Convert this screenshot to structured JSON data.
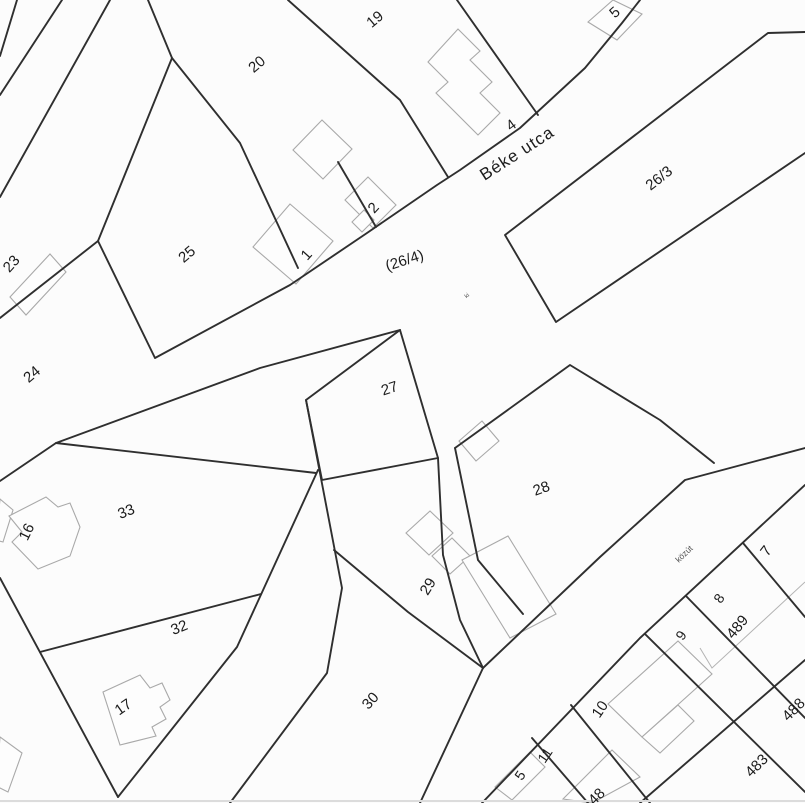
{
  "map": {
    "type": "cadastral-parcel-map",
    "street_name": "Béke utca",
    "road_label_center": "(26/4)",
    "road_label_right": "közút",
    "colors": {
      "background": "#fcfcfc",
      "parcel_boundary": "#2f2f2f",
      "building_outline": "#a9a9a9",
      "label_text": "#1c1c1c",
      "small_label_text": "#555555"
    },
    "labels": [
      {
        "id": "street-label-beke-utca",
        "text": "Béke utca",
        "x": 520,
        "y": 158,
        "rot": -33,
        "size": 17,
        "cls": "map-label",
        "ls": 1
      },
      {
        "id": "road-label-26-4",
        "text": "(26/4)",
        "x": 406,
        "y": 265,
        "rot": -18,
        "size": 15,
        "cls": "map-label",
        "ls": 0
      },
      {
        "id": "parcel-label-26-3",
        "text": "26/3",
        "x": 662,
        "y": 182,
        "rot": -38,
        "size": 15,
        "cls": "map-label",
        "ls": 0
      },
      {
        "id": "small-label-ki",
        "text": "ki",
        "x": 468,
        "y": 297,
        "rot": -40,
        "size": 6,
        "cls": "small-label",
        "ls": 0
      },
      {
        "id": "road-label-kozut",
        "text": "közút",
        "x": 686,
        "y": 556,
        "rot": -44,
        "size": 8.5,
        "cls": "small-label",
        "ls": 0
      },
      {
        "id": "parcel-label-19",
        "text": "19",
        "x": 378,
        "y": 23,
        "rot": -40,
        "size": 15,
        "cls": "map-label",
        "ls": 0
      },
      {
        "id": "parcel-label-20",
        "text": "20",
        "x": 260,
        "y": 68,
        "rot": -40,
        "size": 15,
        "cls": "map-label",
        "ls": 0
      },
      {
        "id": "parcel-label-5-top",
        "text": "5",
        "x": 618,
        "y": 16,
        "rot": -42,
        "size": 15,
        "cls": "map-label",
        "ls": 0
      },
      {
        "id": "parcel-label-4",
        "text": "4",
        "x": 514,
        "y": 129,
        "rot": -36,
        "size": 15,
        "cls": "map-label",
        "ls": 0
      },
      {
        "id": "parcel-label-23",
        "text": "23",
        "x": 15,
        "y": 267,
        "rot": -48,
        "size": 15,
        "cls": "map-label",
        "ls": 0
      },
      {
        "id": "parcel-label-25",
        "text": "25",
        "x": 190,
        "y": 258,
        "rot": -40,
        "size": 15,
        "cls": "map-label",
        "ls": 0
      },
      {
        "id": "parcel-label-1",
        "text": "1",
        "x": 310,
        "y": 258,
        "rot": -48,
        "size": 15,
        "cls": "map-label",
        "ls": 0
      },
      {
        "id": "parcel-label-2",
        "text": "2",
        "x": 377,
        "y": 211,
        "rot": -48,
        "size": 15,
        "cls": "map-label",
        "ls": 0
      },
      {
        "id": "parcel-label-24",
        "text": "24",
        "x": 35,
        "y": 378,
        "rot": -40,
        "size": 15,
        "cls": "map-label",
        "ls": 0
      },
      {
        "id": "parcel-label-27",
        "text": "27",
        "x": 391,
        "y": 393,
        "rot": -18,
        "size": 15,
        "cls": "map-label",
        "ls": 0
      },
      {
        "id": "parcel-label-28",
        "text": "28",
        "x": 543,
        "y": 493,
        "rot": -20,
        "size": 15,
        "cls": "map-label",
        "ls": 0
      },
      {
        "id": "parcel-label-33",
        "text": "33",
        "x": 128,
        "y": 516,
        "rot": -22,
        "size": 15,
        "cls": "map-label",
        "ls": 0
      },
      {
        "id": "parcel-label-16",
        "text": "16",
        "x": 31,
        "y": 534,
        "rot": -64,
        "size": 15,
        "cls": "map-label",
        "ls": 0
      },
      {
        "id": "parcel-label-29",
        "text": "29",
        "x": 432,
        "y": 589,
        "rot": -58,
        "size": 15,
        "cls": "map-label",
        "ls": 0
      },
      {
        "id": "parcel-label-32",
        "text": "32",
        "x": 181,
        "y": 632,
        "rot": -22,
        "size": 15,
        "cls": "map-label",
        "ls": 0
      },
      {
        "id": "parcel-label-17",
        "text": "17",
        "x": 126,
        "y": 711,
        "rot": -35,
        "size": 15,
        "cls": "map-label",
        "ls": 0
      },
      {
        "id": "parcel-label-30",
        "text": "30",
        "x": 374,
        "y": 704,
        "rot": -48,
        "size": 15,
        "cls": "map-label",
        "ls": 0
      },
      {
        "id": "parcel-label-7",
        "text": "7",
        "x": 770,
        "y": 554,
        "rot": -52,
        "size": 15,
        "cls": "map-label",
        "ls": 0
      },
      {
        "id": "parcel-label-8",
        "text": "8",
        "x": 723,
        "y": 601,
        "rot": -56,
        "size": 14,
        "cls": "map-label",
        "ls": 0
      },
      {
        "id": "parcel-label-489",
        "text": "489",
        "x": 741,
        "y": 630,
        "rot": -50,
        "size": 15,
        "cls": "map-label",
        "ls": 0
      },
      {
        "id": "parcel-label-9",
        "text": "9",
        "x": 685,
        "y": 638,
        "rot": -56,
        "size": 14,
        "cls": "map-label",
        "ls": 0
      },
      {
        "id": "parcel-label-10",
        "text": "10",
        "x": 604,
        "y": 712,
        "rot": -56,
        "size": 15,
        "cls": "map-label",
        "ls": 0
      },
      {
        "id": "parcel-label-488",
        "text": "488",
        "x": 797,
        "y": 713,
        "rot": -45,
        "size": 15,
        "cls": "map-label",
        "ls": 0
      },
      {
        "id": "parcel-label-483",
        "text": "483",
        "x": 760,
        "y": 769,
        "rot": -45,
        "size": 15,
        "cls": "map-label",
        "ls": 0
      },
      {
        "id": "parcel-label-11",
        "text": "11",
        "x": 549,
        "y": 758,
        "rot": -56,
        "size": 14,
        "cls": "map-label",
        "ls": 0
      },
      {
        "id": "parcel-label-5-bottom",
        "text": "5",
        "x": 524,
        "y": 778,
        "rot": -56,
        "size": 14,
        "cls": "map-label",
        "ls": 0
      },
      {
        "id": "parcel-label-48-cut",
        "text": "48",
        "x": 600,
        "y": 800,
        "rot": -45,
        "size": 15,
        "cls": "map-label",
        "ls": 0
      }
    ]
  }
}
